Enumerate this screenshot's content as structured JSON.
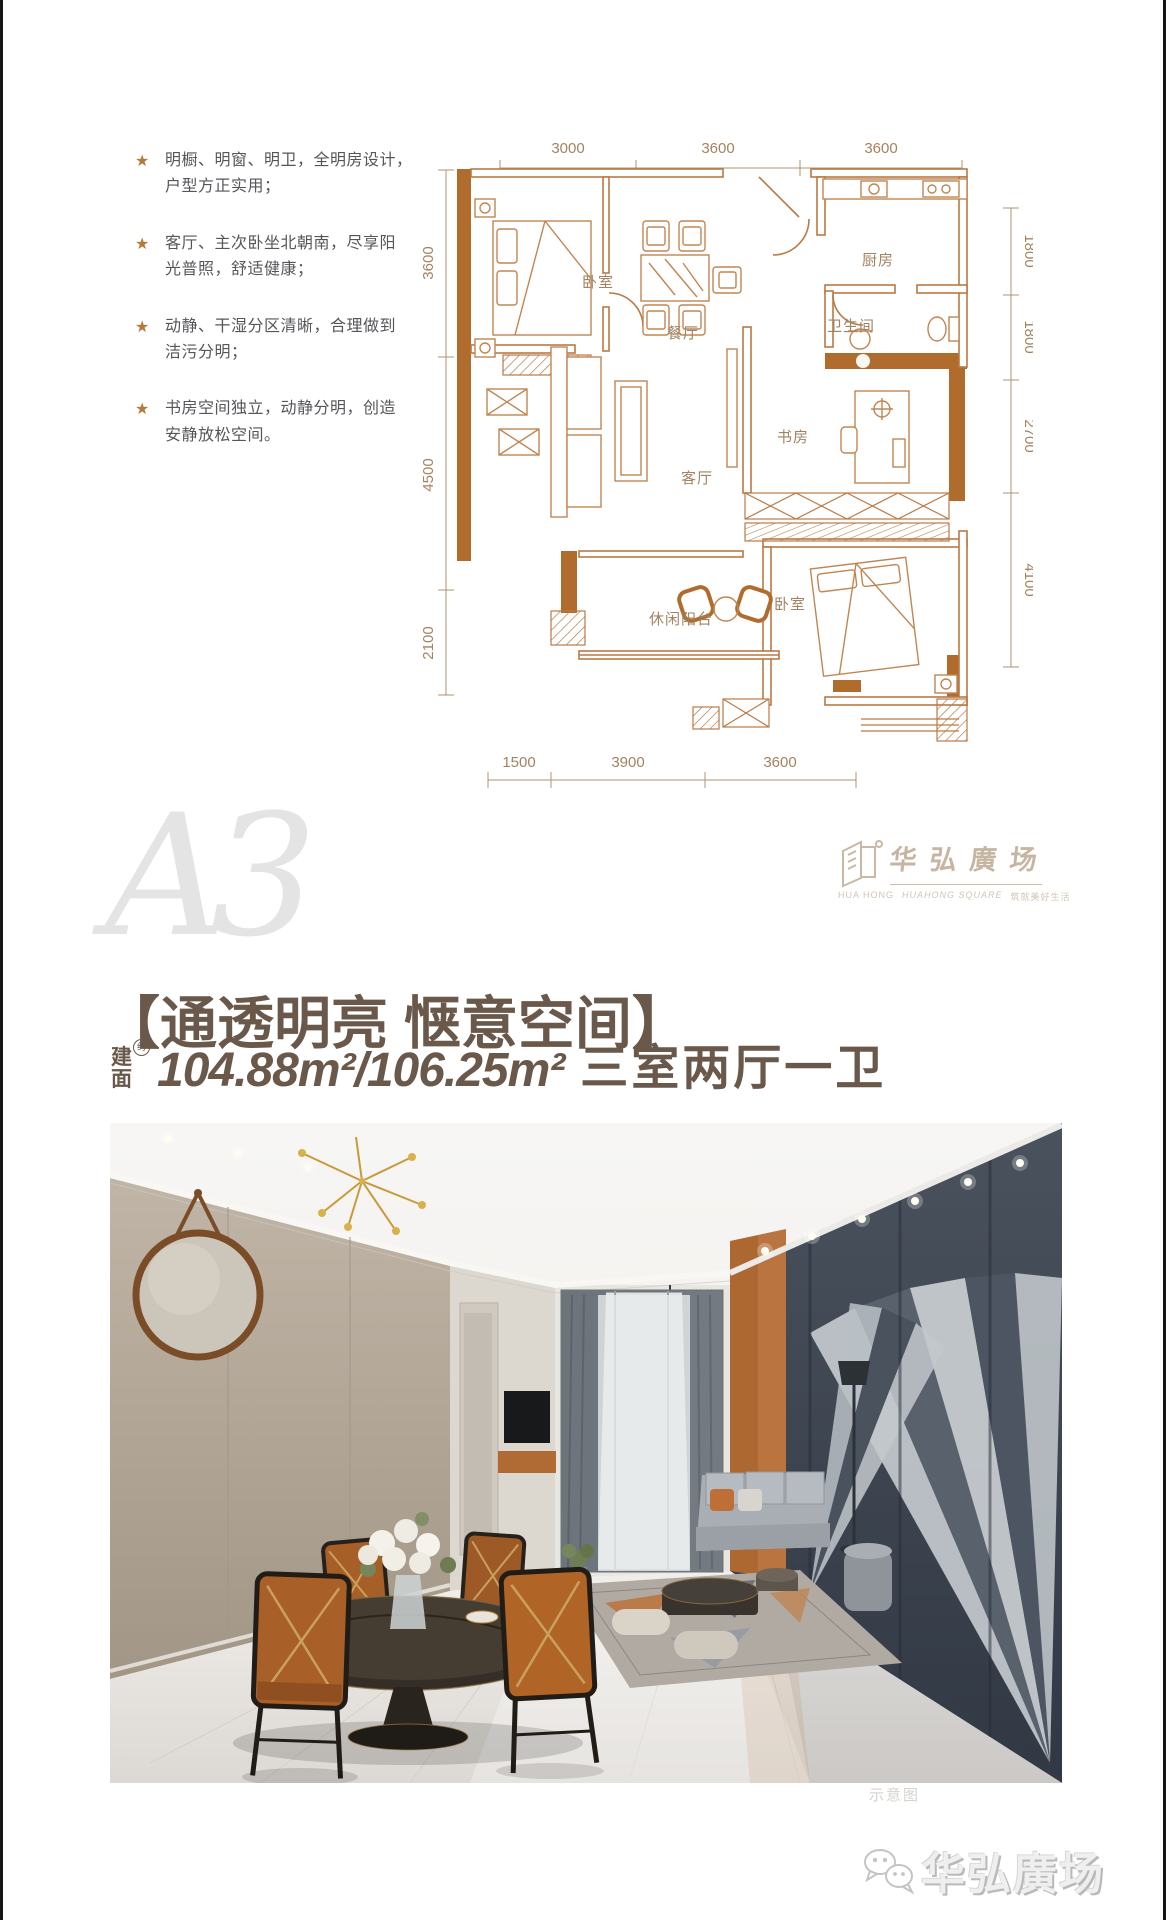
{
  "features": {
    "bullet": "★",
    "items": [
      {
        "line1": "明橱、明窗、明卫，全明房设计，",
        "line2": "户型方正实用；"
      },
      {
        "line1": "客厅、主次卧坐北朝南，尽享阳",
        "line2": "光普照，舒适健康；"
      },
      {
        "line1": "动静、干湿分区清晰，合理做到",
        "line2": "洁污分明；"
      },
      {
        "line1": "书房空间独立，动静分明，创造",
        "line2": "安静放松空间。"
      }
    ]
  },
  "floorplan": {
    "dims_top": [
      "3000",
      "3600",
      "3600"
    ],
    "dims_right": [
      "1800",
      "1800",
      "2700",
      "4100"
    ],
    "dims_left": [
      "3600",
      "4500",
      "2100"
    ],
    "dims_bottom": [
      "1500",
      "3900",
      "3600"
    ],
    "rooms": {
      "bedroom1": "卧室",
      "dining": "餐厅",
      "kitchen": "厨房",
      "bath": "卫生间",
      "study": "书房",
      "living": "客厅",
      "balcony": "休闲阳台",
      "bedroom2": "卧室"
    }
  },
  "watermark": {
    "unit_label": "A3"
  },
  "brand": {
    "name_cn": "华弘廣场",
    "sub_left": "HUA HONG",
    "sub_mid": "HUAHONG SQUARE",
    "sub_right": "筑就美好生活"
  },
  "headline": {
    "title": "【通透明亮  惬意空间】",
    "area_label_top": "建",
    "area_label_bottom": "面",
    "area_approx": "约",
    "area_value": "104.88m²/106.25m²",
    "rooms_text": "三室两厅一卫"
  },
  "photo": {
    "watermark": "示意图"
  },
  "footer": {
    "brand": "华弘廣场"
  },
  "colors": {
    "plan_line": "#b97a45",
    "plan_wall": "#b06c2d",
    "dim_text": "#a3835f",
    "headline": "#6a584a",
    "star": "#b5793a",
    "logo": "#c6b5a1"
  }
}
